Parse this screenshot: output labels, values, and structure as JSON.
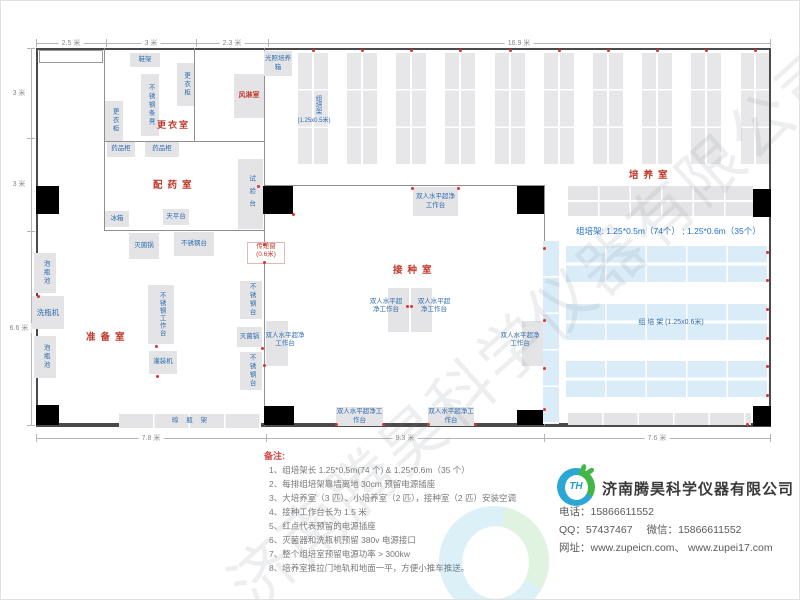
{
  "watermark": "济南腾昊科学仪器有限公司",
  "dimensions": {
    "top": [
      "2.5 米",
      "3 米",
      "2.3 米",
      "16.9 米"
    ],
    "left": [
      "3 米",
      "3 米",
      "6.6 米"
    ],
    "bottom": [
      "7.8 米",
      "9.3 米",
      "7.6 米"
    ]
  },
  "rooms": {
    "changing": "更衣室",
    "air_shower": "风淋室",
    "dispensing": "配药室",
    "prep": "准备室",
    "inoculation": "接种室",
    "culture": "培养室",
    "pass_window": "传递窗",
    "pass_window_size": "(0.6米)"
  },
  "equipment": {
    "shoe_rack": "鞋架",
    "locker": "更衣柜",
    "steel_bench": "不锈钢条凳",
    "med_cabinet": "药品柜",
    "test_bench": "试验台",
    "fridge": "冰箱",
    "balance_table": "天平台",
    "sterilizer": "灭菌锅",
    "steel_table": "不锈钢台",
    "soak_pool": "泡瓶池",
    "bottle_washer": "洗瓶机",
    "steel_worktable": "不锈钢工作台",
    "filling_machine": "灌装机",
    "drying_rack": "晾 瓶 架",
    "laminar_bench": "双人水平超净工作台",
    "light_incubator": "光照培养箱",
    "rack_v_label": "组培架",
    "rack_v_size": "(1.25x0.5米)",
    "rack_blue_label": "组 培 架 (1.25x0.6米)"
  },
  "annotations": {
    "rack_summary": "组培架: 1.25*0.5m（74个） ; 1.25*0.6m（35个）"
  },
  "notes": {
    "title": "备注:",
    "items": [
      "1、组培架长 1.25*0.5m(74 个) & 1.25*0.6m（35 个）",
      "2、每排组培架靠墙离地 30cm 预留电源插座",
      "3、大培养室（3 匹）、小培养室（2 匹），接种室（2 匹）安装空调",
      "4、接种工作台长为 1.5 米",
      "5、红点代表预留的电源插座",
      "6、灭菌器和洗瓶机预留 380v 电源接口",
      "7、整个组培室预留电源功率 > 300kw",
      "8、培养室推拉门地轨和地面一平，方便小推车推送。"
    ]
  },
  "company": {
    "logo_text": "TH",
    "name": "济南腾昊科学仪器有限公司",
    "phone_label": "电话：",
    "phone": "15866611552",
    "qq_label": "QQ：",
    "qq": "57437467",
    "wechat_label": "微信：",
    "wechat": "15866611552",
    "web_label": "网址：",
    "websites": "www.zupeicn.com、 www.zupei17.com"
  },
  "colors": {
    "room_label": "#c0392b",
    "equipment_label": "#2b6cb0",
    "socket_dot": "#e03131",
    "blue_rack": "#d9ecf8",
    "gray_rack": "#e4e4e6",
    "wall": "#4a4a4a"
  }
}
